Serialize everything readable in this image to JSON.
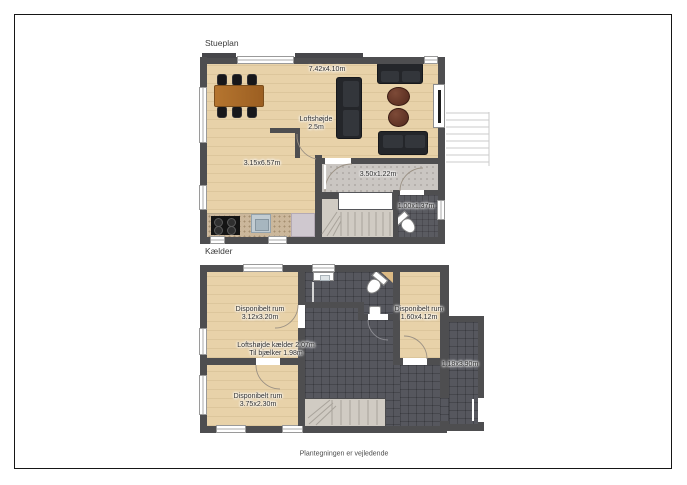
{
  "caption": "Plantegningen er vejledende",
  "stueplan": {
    "title": "Stueplan",
    "labels": {
      "living_dims": "7.42x4.10m",
      "ceiling_line1": "Loftshøjde",
      "ceiling_line2": "2.5m",
      "kitchen_dims": "3.15x6.57m",
      "hall_dims": "3.50x1.22m",
      "wc_dims": "1.00x1.37m"
    }
  },
  "kaelder": {
    "title": "Kælder",
    "labels": {
      "room_topleft_line1": "Disponibelt rum",
      "room_topleft_line2": "3.12x3.20m",
      "room_right_line1": "Disponibelt rum",
      "room_right_line2": "1.60x4.12m",
      "ceiling_line1": "Loftshøjde kælder 2.07m",
      "ceiling_line2": "Til bjælker 1.98m",
      "room_bottomleft_line1": "Disponibelt rum",
      "room_bottomleft_line2": "3.75x2.30m",
      "ext_dims": "1.18x3.90m"
    }
  },
  "colors": {
    "wall": "#4e4e50",
    "wood_floor": "#e8d2a9",
    "dark_tile": "#56575e",
    "hall_floor": "#cac6c2",
    "stair_floor": "#d0cbc3",
    "table_wood": "#b5752f",
    "sofa": "#24262a",
    "frame_border": "#161616"
  }
}
